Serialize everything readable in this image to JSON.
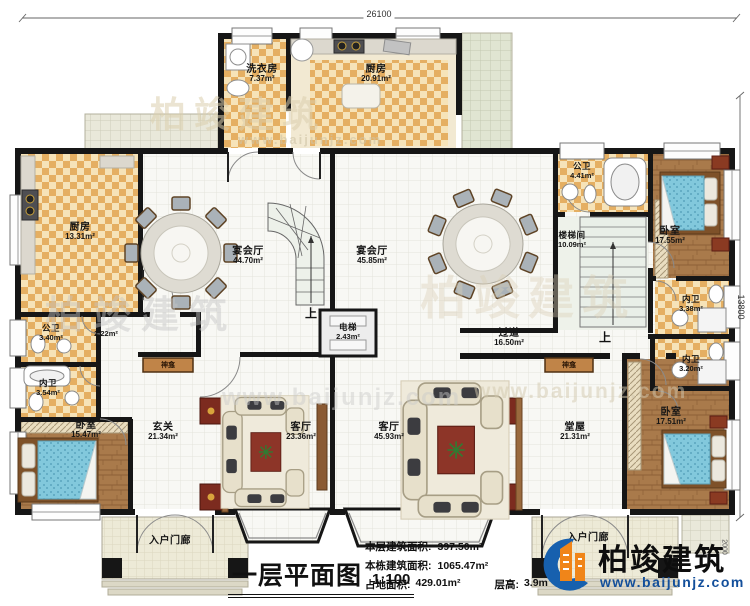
{
  "plan": {
    "rooms": {
      "laundry": {
        "name": "洗衣房",
        "area": "7.37m²"
      },
      "kitchen_top": {
        "name": "厨房",
        "area": "20.91m²"
      },
      "kitchen_left": {
        "name": "厨房",
        "area": "13.31m²"
      },
      "banquet_left": {
        "name": "宴会厅",
        "area": "44.70m²"
      },
      "banquet_right": {
        "name": "宴会厅",
        "area": "45.85m²"
      },
      "public_bath_top": {
        "name": "公卫",
        "area": "4.41m²"
      },
      "stairwell": {
        "name": "楼梯间",
        "area": "10.09m²"
      },
      "bedroom_top_right": {
        "name": "卧室",
        "area": "17.55m²"
      },
      "ensuite_top_right": {
        "name": "内卫",
        "area": "3.38m²"
      },
      "public_bath_left": {
        "name": "公卫",
        "area": "3.40m²"
      },
      "niche": {
        "name": "",
        "area": "2.22m²"
      },
      "ensuite_left": {
        "name": "内卫",
        "area": "3.54m²"
      },
      "bedroom_left": {
        "name": "卧室",
        "area": "15.47m²"
      },
      "elevator": {
        "name": "电梯",
        "area": "2.43m²"
      },
      "hallway": {
        "name": "过道",
        "area": "16.50m²"
      },
      "foyer": {
        "name": "玄关",
        "area": "21.34m²"
      },
      "living_left": {
        "name": "客厅",
        "area": "23.36m²"
      },
      "living_right": {
        "name": "客厅",
        "area": "45.93m²"
      },
      "main_hall": {
        "name": "堂屋",
        "area": "21.31m²"
      },
      "ensuite_bottom_right": {
        "name": "内卫",
        "area": "3.20m²"
      },
      "bedroom_bottom_right": {
        "name": "卧室",
        "area": "17.51m²"
      },
      "porch_left": {
        "name": "入户门廊"
      },
      "porch_right": {
        "name": "入户门廊"
      }
    },
    "markers": {
      "up": "上",
      "shrine": "神龛"
    },
    "dims": {
      "width": "26100",
      "height": "13800",
      "porch": "2000"
    }
  },
  "footer": {
    "title": "一层平面图",
    "scale": "1:100",
    "stats": [
      {
        "label": "本层建筑面积:",
        "value": "397.50m²"
      },
      {
        "label": "本栋建筑面积:",
        "value": "1065.47m²"
      },
      {
        "label": "占地面积:",
        "value": "429.01m²"
      },
      {
        "label": "层高:",
        "value": "3.9m"
      }
    ]
  },
  "brand": {
    "name": "柏竣建筑",
    "website": "www.baijunjz.com"
  },
  "colors": {
    "wall": "#161616",
    "checker": "#e5af62",
    "wood": "#a97a4b",
    "accent_blue": "#134f9b",
    "accent_orange": "#f08519"
  }
}
